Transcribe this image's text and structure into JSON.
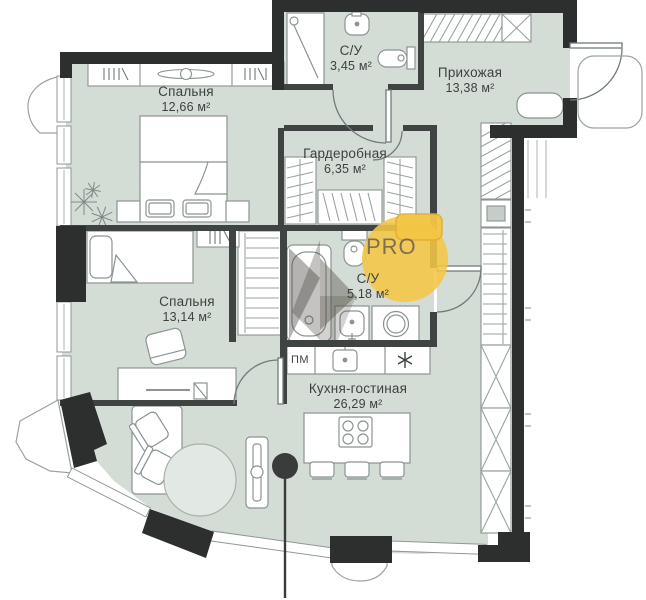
{
  "plan": {
    "rooms": [
      {
        "key": "bedroom-1",
        "name": "Спальня",
        "area": "12,66 м²"
      },
      {
        "key": "bathroom-1",
        "name": "С/У",
        "area": "3,45 м²"
      },
      {
        "key": "hallway",
        "name": "Прихожая",
        "area": "13,38 м²"
      },
      {
        "key": "wardrobe",
        "name": "Гардеробная",
        "area": "6,35 м²"
      },
      {
        "key": "bathroom-2",
        "name": "С/У",
        "area": "5,18 м²"
      },
      {
        "key": "bedroom-2",
        "name": "Спальня",
        "area": "13,14 м²"
      },
      {
        "key": "kitchen-living",
        "name": "Кухня-гостиная",
        "area": "26,29 м²"
      }
    ],
    "appliance_labels": {
      "dishwasher": "ПМ"
    },
    "watermark": {
      "brand": "PRO"
    },
    "icons": {
      "fridge": "snowflake-icon",
      "marker": "location-pin-icon"
    },
    "colors": {
      "floor": "#d4dcd6",
      "walls": "#2d2e2e",
      "watermark_yellow": "#f4c645"
    }
  }
}
